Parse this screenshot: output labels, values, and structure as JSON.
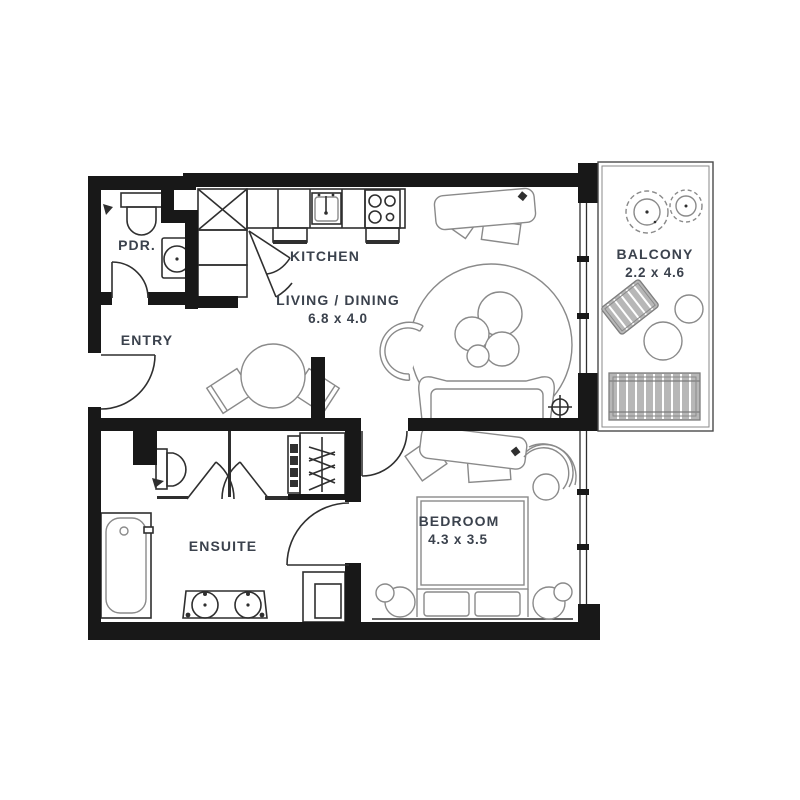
{
  "plan_title": "One-bedroom apartment floor plan",
  "colors": {
    "wall": "#181818",
    "furniture_line": "#8a8a8a",
    "dark_line": "#2f2f2f",
    "text": "#3b424d",
    "balcony_gray": "#b7b7b7"
  },
  "rooms": {
    "pdr": {
      "label": "PDR.",
      "furniture": [
        "toilet",
        "basin"
      ]
    },
    "entry": {
      "label": "ENTRY",
      "furniture": [
        "entry-door"
      ]
    },
    "kitchen": {
      "label": "KITCHEN",
      "furniture": [
        "tall-cabinet",
        "corner-cabinet",
        "counter",
        "sink",
        "cooktop"
      ]
    },
    "living": {
      "label": "LIVING / DINING",
      "dims": "6.8 x 4.0",
      "furniture": [
        "desk",
        "desk-chair",
        "round-rug",
        "coffee-tables",
        "sofa",
        "armchair",
        "dining-table",
        "dining-chairs"
      ]
    },
    "balcony": {
      "label": "BALCONY",
      "dims": "2.2 x 4.6",
      "furniture": [
        "plants",
        "lounge-chair",
        "side-tables",
        "bench"
      ]
    },
    "ensuite": {
      "label": "ENSUITE",
      "furniture": [
        "toilet",
        "double-doors",
        "shelves",
        "wardrobe",
        "bathtub",
        "double-vanity",
        "cabinet"
      ]
    },
    "bedroom": {
      "label": "BEDROOM",
      "dims": "4.3 x 3.5",
      "furniture": [
        "desk",
        "desk-chair",
        "curved-chair",
        "bed",
        "pillows",
        "bedside-tables"
      ]
    }
  }
}
